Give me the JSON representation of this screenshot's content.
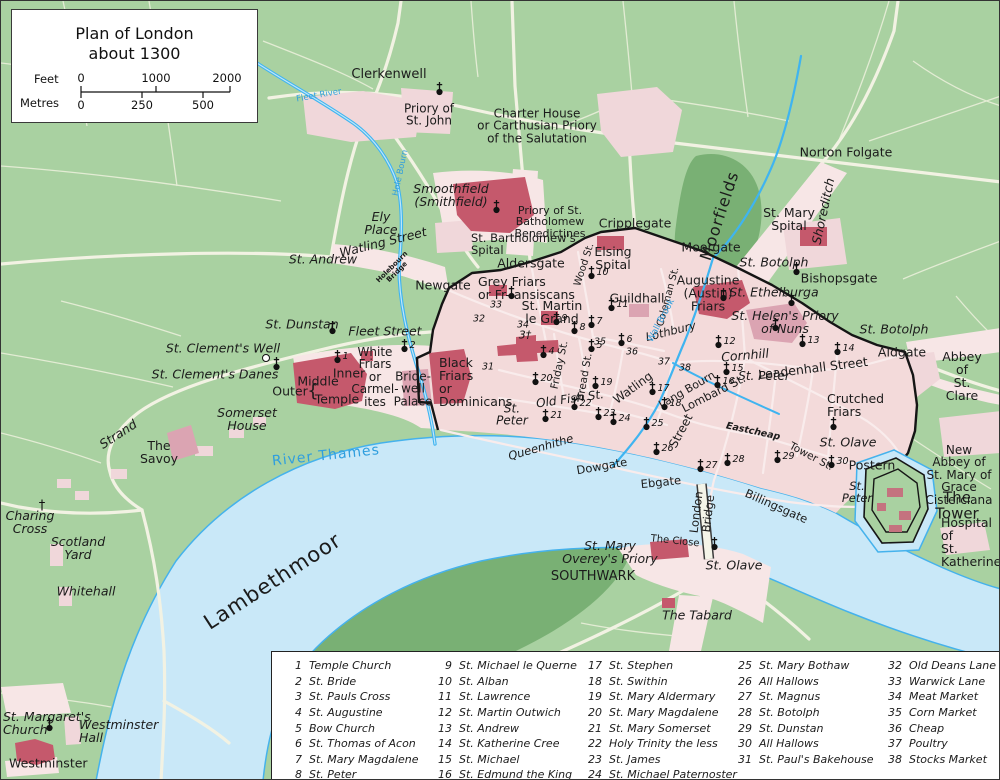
{
  "title_box": {
    "title_line1": "Plan of London",
    "title_line2": "about 1300",
    "feet_label": "Feet",
    "metres_label": "Metres",
    "feet_ticks": [
      "0",
      "1000",
      "2000"
    ],
    "metre_ticks": [
      "0",
      "250",
      "500"
    ]
  },
  "colors": {
    "field_green": "#a9d1a1",
    "moor_green": "#79b074",
    "water_fill": "#c9e8f8",
    "water_stroke": "#45b2ec",
    "stream_blue": "#3fb4f0",
    "city_pink": "#f3dada",
    "suburb_pink": "#f7e6e6",
    "building_red": "#c5596c",
    "building_pink": "#dba4b2",
    "wall_black": "#151515",
    "water_label_blue": "#2f9ede"
  },
  "map": {
    "labels": [
      {
        "t": "Fleet River",
        "x": 318,
        "y": 95,
        "fs": 8.5,
        "c": "w",
        "rot": -10
      },
      {
        "t": "Clerkenwell",
        "x": 388,
        "y": 74,
        "fs": 13
      },
      {
        "t": "Priory of\nSt. John",
        "x": 428,
        "y": 114,
        "fs": 12
      },
      {
        "t": "Charter House\nor Carthusian Priory\nof the Salutation",
        "x": 536,
        "y": 125,
        "fs": 12
      },
      {
        "t": "Norton Folgate",
        "x": 845,
        "y": 151,
        "fs": 12.5
      },
      {
        "t": "Moorfields",
        "x": 719,
        "y": 215,
        "fs": 16,
        "rot": -72,
        "ls": 1
      },
      {
        "t": "Shoreditch",
        "x": 822,
        "y": 210,
        "fs": 12.5,
        "it": 1,
        "rot": -78
      },
      {
        "t": "St. Mary\nSpital",
        "x": 788,
        "y": 218,
        "fs": 12.5
      },
      {
        "t": "St. Botolph",
        "x": 773,
        "y": 261,
        "fs": 12.5,
        "it": 1
      },
      {
        "t": "Bishopsgate",
        "x": 838,
        "y": 277,
        "fs": 12.5
      },
      {
        "t": "Hole Bourn",
        "x": 400,
        "y": 172,
        "fs": 8.5,
        "c": "w",
        "rot": -78
      },
      {
        "t": "Smoothfield\n(Smithfield)",
        "x": 450,
        "y": 194,
        "fs": 12.5,
        "it": 1
      },
      {
        "t": "Ely\nPlace",
        "x": 380,
        "y": 222,
        "fs": 12.5,
        "it": 1
      },
      {
        "t": "Watling Street",
        "x": 382,
        "y": 241,
        "fs": 12.5,
        "it": 1,
        "rot": -14
      },
      {
        "t": "St. Andrew",
        "x": 322,
        "y": 258,
        "fs": 12.5,
        "it": 1
      },
      {
        "t": "Holebourn\nBridge",
        "x": 394,
        "y": 269,
        "fs": 7,
        "b": 1,
        "rot": -45
      },
      {
        "t": "Newgate",
        "x": 442,
        "y": 284,
        "fs": 12.5
      },
      {
        "t": "Priory of St.\nBatholomew\nBenedictines",
        "x": 549,
        "y": 221,
        "fs": 11
      },
      {
        "t": "St. Bartholomew's\nSpital",
        "x": 470,
        "y": 244,
        "fs": 11.5,
        "al": "l"
      },
      {
        "t": "Aldersgate",
        "x": 530,
        "y": 262,
        "fs": 12.5
      },
      {
        "t": "Cripplegate",
        "x": 634,
        "y": 222,
        "fs": 12.5
      },
      {
        "t": "Elsing\nSpital",
        "x": 612,
        "y": 257,
        "fs": 12.5
      },
      {
        "t": "Moorgate",
        "x": 710,
        "y": 246,
        "fs": 12.5
      },
      {
        "t": "Grey Friars\nor Fr-  ansiscans",
        "x": 477,
        "y": 287,
        "fs": 12.5,
        "al": "l"
      },
      {
        "t": "St. Martin\nle Grand",
        "x": 551,
        "y": 311,
        "fs": 12.5
      },
      {
        "t": "Guildhall",
        "x": 636,
        "y": 297,
        "fs": 12.5
      },
      {
        "t": "Augustine\n(Austin)\nFriars",
        "x": 707,
        "y": 292,
        "fs": 12.5
      },
      {
        "t": "St. Ethelburga",
        "x": 773,
        "y": 291,
        "fs": 12.5,
        "it": 1
      },
      {
        "t": "St. Helen's Priory\nof Nuns",
        "x": 784,
        "y": 321,
        "fs": 12.5,
        "it": 1
      },
      {
        "t": "St. Botolph",
        "x": 893,
        "y": 328,
        "fs": 12.5,
        "it": 1
      },
      {
        "t": "Aldgate",
        "x": 901,
        "y": 351,
        "fs": 12.5
      },
      {
        "t": "Abbey of\nSt. Clare",
        "x": 961,
        "y": 375,
        "fs": 12.5
      },
      {
        "t": "Wood St.",
        "x": 584,
        "y": 264,
        "fs": 10,
        "rot": -72
      },
      {
        "t": "Coleman St.",
        "x": 668,
        "y": 296,
        "fs": 10,
        "rot": -75
      },
      {
        "t": "Lothbury",
        "x": 670,
        "y": 331,
        "fs": 11.5,
        "it": 1,
        "rot": -14
      },
      {
        "t": "Wall Brook",
        "x": 661,
        "y": 320,
        "fs": 9,
        "c": "w",
        "rot": -62
      },
      {
        "t": "Cornhill",
        "x": 744,
        "y": 354,
        "fs": 12.5,
        "it": 1,
        "rot": -5
      },
      {
        "t": "Leadenhall Street",
        "x": 812,
        "y": 367,
        "fs": 12.5,
        "rot": -7
      },
      {
        "t": "St. Peter",
        "x": 763,
        "y": 375,
        "fs": 12,
        "it": 1
      },
      {
        "t": "Lang Bourn",
        "x": 686,
        "y": 389,
        "fs": 11,
        "rot": -30
      },
      {
        "t": "Lombard St.",
        "x": 713,
        "y": 393,
        "fs": 11.5,
        "rot": -27
      },
      {
        "t": "Friday St.",
        "x": 559,
        "y": 364,
        "fs": 10.5,
        "rot": -78
      },
      {
        "t": "Bread St.",
        "x": 584,
        "y": 376,
        "fs": 10.5,
        "rot": -80
      },
      {
        "t": "Watling",
        "x": 632,
        "y": 387,
        "fs": 12,
        "rot": -36
      },
      {
        "t": "Street",
        "x": 680,
        "y": 430,
        "fs": 12,
        "rot": -62
      },
      {
        "t": "Old Fish St.",
        "x": 569,
        "y": 398,
        "fs": 12,
        "it": 1,
        "rot": -8
      },
      {
        "t": "St.\nPeter",
        "x": 511,
        "y": 414,
        "fs": 12,
        "it": 1
      },
      {
        "t": "Eastcheap",
        "x": 752,
        "y": 431,
        "fs": 9.5,
        "b": 1,
        "it": 1,
        "rot": 12
      },
      {
        "t": "Tower St.",
        "x": 810,
        "y": 456,
        "fs": 10.5,
        "rot": 28
      },
      {
        "t": "Crutched\nFriars",
        "x": 826,
        "y": 404,
        "fs": 12.5,
        "al": "l"
      },
      {
        "t": "St. Olave",
        "x": 847,
        "y": 441,
        "fs": 12.5,
        "it": 1
      },
      {
        "t": "Postern",
        "x": 871,
        "y": 464,
        "fs": 12.5
      },
      {
        "t": "St.\nPeter",
        "x": 856,
        "y": 492,
        "fs": 11.5,
        "it": 1
      },
      {
        "t": "The Tower",
        "x": 956,
        "y": 505,
        "fs": 15
      },
      {
        "t": "New Abbey of\nSt. Mary of\nGrace\nCisterciana",
        "x": 958,
        "y": 474,
        "fs": 12
      },
      {
        "t": "Hospital of\nSt.\nKatherine",
        "x": 940,
        "y": 541,
        "fs": 12.5,
        "al": "l"
      },
      {
        "t": "Queenhithe",
        "x": 540,
        "y": 447,
        "fs": 11.5,
        "it": 1,
        "rot": -16
      },
      {
        "t": "Dowgate",
        "x": 601,
        "y": 466,
        "fs": 11.5,
        "rot": -10
      },
      {
        "t": "Ebgate",
        "x": 660,
        "y": 482,
        "fs": 11.5,
        "rot": -6
      },
      {
        "t": "Billingsgate",
        "x": 775,
        "y": 506,
        "fs": 11.5,
        "rot": 24
      },
      {
        "t": "London\nBridge",
        "x": 702,
        "y": 512,
        "fs": 11.5,
        "rot": -83
      },
      {
        "t": "River Thames",
        "x": 325,
        "y": 455,
        "fs": 14,
        "c": "w",
        "rot": -6,
        "ls": 1
      },
      {
        "t": "The Close",
        "x": 674,
        "y": 541,
        "fs": 10,
        "rot": 6
      },
      {
        "t": "St. Mary\nOverey's Priory",
        "x": 609,
        "y": 551,
        "fs": 12.5,
        "it": 1
      },
      {
        "t": "SOUTHWARK",
        "x": 592,
        "y": 576,
        "fs": 13
      },
      {
        "t": "St. Olave",
        "x": 733,
        "y": 564,
        "fs": 12.5,
        "it": 1
      },
      {
        "t": "The Tabard",
        "x": 696,
        "y": 614,
        "fs": 12.5,
        "it": 1
      },
      {
        "t": "Strand",
        "x": 117,
        "y": 433,
        "fs": 12.5,
        "it": 1,
        "rot": -33
      },
      {
        "t": "Somerset\nHouse",
        "x": 246,
        "y": 418,
        "fs": 12.5,
        "it": 1
      },
      {
        "t": "The\nSavoy",
        "x": 158,
        "y": 451,
        "fs": 12.5
      },
      {
        "t": "Charing\nCross",
        "x": 29,
        "y": 521,
        "fs": 12.5,
        "it": 1
      },
      {
        "t": "Scotland\nYard",
        "x": 77,
        "y": 547,
        "fs": 12.5,
        "it": 1
      },
      {
        "t": "Whitehall",
        "x": 85,
        "y": 590,
        "fs": 12.5,
        "it": 1
      },
      {
        "t": "Lambethmoor",
        "x": 272,
        "y": 581,
        "fs": 21,
        "rot": -33,
        "ls": 1
      },
      {
        "t": "St. Margaret's\nChurch",
        "x": 2,
        "y": 722,
        "fs": 12.5,
        "it": 1,
        "al": "l"
      },
      {
        "t": "Westminster\nHall",
        "x": 78,
        "y": 730,
        "fs": 12.5,
        "it": 1,
        "al": "l"
      },
      {
        "t": "Westminster",
        "x": 8,
        "y": 762,
        "fs": 12.5,
        "al": "l"
      },
      {
        "t": "St. Dunstan",
        "x": 301,
        "y": 323,
        "fs": 12.5,
        "it": 1
      },
      {
        "t": "Fleet Street",
        "x": 384,
        "y": 330,
        "fs": 12.5,
        "it": 1
      },
      {
        "t": "St. Clement's Well",
        "x": 222,
        "y": 347,
        "fs": 12.5,
        "it": 1
      },
      {
        "t": "St. Clement's Danes",
        "x": 214,
        "y": 373,
        "fs": 12.5,
        "it": 1
      },
      {
        "t": "Inner",
        "x": 348,
        "y": 372,
        "fs": 12.5
      },
      {
        "t": "Middle",
        "x": 317,
        "y": 380,
        "fs": 12.5
      },
      {
        "t": "Outer",
        "x": 289,
        "y": 390,
        "fs": 12.5
      },
      {
        "t": "Temple",
        "x": 336,
        "y": 398,
        "fs": 12.5
      },
      {
        "t": "{",
        "x": 312,
        "y": 391,
        "fs": 18
      },
      {
        "t": "White\nFriars\nor\nCarmel-\nites",
        "x": 374,
        "y": 376,
        "fs": 12
      },
      {
        "t": "Bride-\nwell\nPalace",
        "x": 412,
        "y": 388,
        "fs": 12
      },
      {
        "t": "Black\nFriars\nor\nDominicans",
        "x": 438,
        "y": 381,
        "fs": 12.5,
        "al": "l"
      }
    ],
    "markers": [
      {
        "n": "1",
        "t": "church",
        "x": 336,
        "y": 359
      },
      {
        "n": "2",
        "t": "church",
        "x": 403,
        "y": 348
      },
      {
        "n": "3",
        "t": "dagger",
        "x": 524,
        "y": 334
      },
      {
        "n": "4",
        "t": "church",
        "x": 542,
        "y": 354
      },
      {
        "n": "5",
        "t": "church",
        "x": 590,
        "y": 348
      },
      {
        "n": "6",
        "t": "church",
        "x": 620,
        "y": 342
      },
      {
        "n": "7",
        "t": "church",
        "x": 590,
        "y": 324
      },
      {
        "n": "8",
        "t": "church",
        "x": 573,
        "y": 330
      },
      {
        "n": "9",
        "t": "church",
        "x": 555,
        "y": 321
      },
      {
        "n": "10",
        "t": "church",
        "x": 590,
        "y": 275
      },
      {
        "n": "11",
        "t": "church",
        "x": 610,
        "y": 307
      },
      {
        "n": "12",
        "t": "church",
        "x": 717,
        "y": 344
      },
      {
        "n": "13",
        "t": "church",
        "x": 801,
        "y": 343
      },
      {
        "n": "14",
        "t": "church",
        "x": 836,
        "y": 351
      },
      {
        "n": "15",
        "t": "church",
        "x": 725,
        "y": 371
      },
      {
        "n": "16",
        "t": "church",
        "x": 716,
        "y": 384
      },
      {
        "n": "17",
        "t": "church",
        "x": 651,
        "y": 391
      },
      {
        "n": "18",
        "t": "church",
        "x": 663,
        "y": 406
      },
      {
        "n": "19",
        "t": "church",
        "x": 594,
        "y": 385
      },
      {
        "n": "20",
        "t": "church",
        "x": 534,
        "y": 381
      },
      {
        "n": "21",
        "t": "church",
        "x": 544,
        "y": 418
      },
      {
        "n": "22",
        "t": "church",
        "x": 573,
        "y": 406
      },
      {
        "n": "23",
        "t": "church",
        "x": 597,
        "y": 416
      },
      {
        "n": "24",
        "t": "church",
        "x": 612,
        "y": 421
      },
      {
        "n": "25",
        "t": "church",
        "x": 645,
        "y": 426
      },
      {
        "n": "26",
        "t": "church",
        "x": 655,
        "y": 451
      },
      {
        "n": "27",
        "t": "church",
        "x": 699,
        "y": 468
      },
      {
        "n": "28",
        "t": "church",
        "x": 726,
        "y": 462
      },
      {
        "n": "29",
        "t": "church",
        "x": 776,
        "y": 459
      },
      {
        "n": "30",
        "t": "church",
        "x": 830,
        "y": 464
      },
      {
        "n": "31",
        "t": "num",
        "x": 487,
        "y": 366
      },
      {
        "n": "32",
        "t": "num",
        "x": 478,
        "y": 318
      },
      {
        "n": "33",
        "t": "num",
        "x": 495,
        "y": 304
      },
      {
        "n": "34",
        "t": "num",
        "x": 522,
        "y": 324
      },
      {
        "n": "35",
        "t": "num",
        "x": 599,
        "y": 341
      },
      {
        "n": "36",
        "t": "num",
        "x": 631,
        "y": 351
      },
      {
        "n": "37",
        "t": "num",
        "x": 663,
        "y": 361
      },
      {
        "n": "38",
        "t": "num",
        "x": 684,
        "y": 367
      },
      {
        "t": "church",
        "x": 438,
        "y": 91
      },
      {
        "t": "church",
        "x": 495,
        "y": 209
      },
      {
        "t": "church",
        "x": 510,
        "y": 295
      },
      {
        "t": "church",
        "x": 795,
        "y": 271
      },
      {
        "t": "church",
        "x": 790,
        "y": 302
      },
      {
        "t": "church",
        "x": 774,
        "y": 327
      },
      {
        "t": "church",
        "x": 722,
        "y": 297
      },
      {
        "t": "church",
        "x": 832,
        "y": 426
      },
      {
        "t": "church",
        "x": 331,
        "y": 330
      },
      {
        "t": "church",
        "x": 275,
        "y": 366
      },
      {
        "t": "church",
        "x": 713,
        "y": 546
      },
      {
        "t": "church",
        "x": 48,
        "y": 727
      },
      {
        "t": "well",
        "x": 265,
        "y": 357
      },
      {
        "t": "cross",
        "x": 41,
        "y": 505
      }
    ]
  },
  "legend": {
    "columns": [
      [
        {
          "n": "1",
          "name": "Temple Church"
        },
        {
          "n": "2",
          "name": "St. Bride"
        },
        {
          "n": "3",
          "name": "St. Pauls Cross"
        },
        {
          "n": "4",
          "name": "St. Augustine"
        },
        {
          "n": "5",
          "name": "Bow Church"
        },
        {
          "n": "6",
          "name": "St. Thomas of Acon"
        },
        {
          "n": "7",
          "name": "St. Mary Magdalene"
        },
        {
          "n": "8",
          "name": "St. Peter"
        }
      ],
      [
        {
          "n": "9",
          "name": "St. Michael le Querne"
        },
        {
          "n": "10",
          "name": "St. Alban"
        },
        {
          "n": "11",
          "name": "St. Lawrence"
        },
        {
          "n": "12",
          "name": "St. Martin Outwich"
        },
        {
          "n": "13",
          "name": "St. Andrew"
        },
        {
          "n": "14",
          "name": "St. Katherine Cree"
        },
        {
          "n": "15",
          "name": "St. Michael"
        },
        {
          "n": "16",
          "name": "St. Edmund the King"
        }
      ],
      [
        {
          "n": "17",
          "name": "St. Stephen"
        },
        {
          "n": "18",
          "name": "St. Swithin"
        },
        {
          "n": "19",
          "name": "St. Mary Aldermary"
        },
        {
          "n": "20",
          "name": "St. Mary Magdalene"
        },
        {
          "n": "21",
          "name": "St. Mary Somerset"
        },
        {
          "n": "22",
          "name": "Holy Trinity the less"
        },
        {
          "n": "23",
          "name": "St. James"
        },
        {
          "n": "24",
          "name": "St. Michael Paternoster"
        }
      ],
      [
        {
          "n": "25",
          "name": "St. Mary Bothaw"
        },
        {
          "n": "26",
          "name": "All Hallows"
        },
        {
          "n": "27",
          "name": "St. Magnus"
        },
        {
          "n": "28",
          "name": "St. Botolph"
        },
        {
          "n": "29",
          "name": "St. Dunstan"
        },
        {
          "n": "30",
          "name": "All Hallows"
        },
        {
          "n": "31",
          "name": "St. Paul's Bakehouse"
        }
      ],
      [
        {
          "n": "32",
          "name": "Old Deans Lane"
        },
        {
          "n": "33",
          "name": "Warwick Lane"
        },
        {
          "n": "34",
          "name": "Meat Market"
        },
        {
          "n": "35",
          "name": "Corn Market"
        },
        {
          "n": "36",
          "name": "Cheap"
        },
        {
          "n": "37",
          "name": "Poultry"
        },
        {
          "n": "38",
          "name": "Stocks Market"
        }
      ]
    ]
  }
}
